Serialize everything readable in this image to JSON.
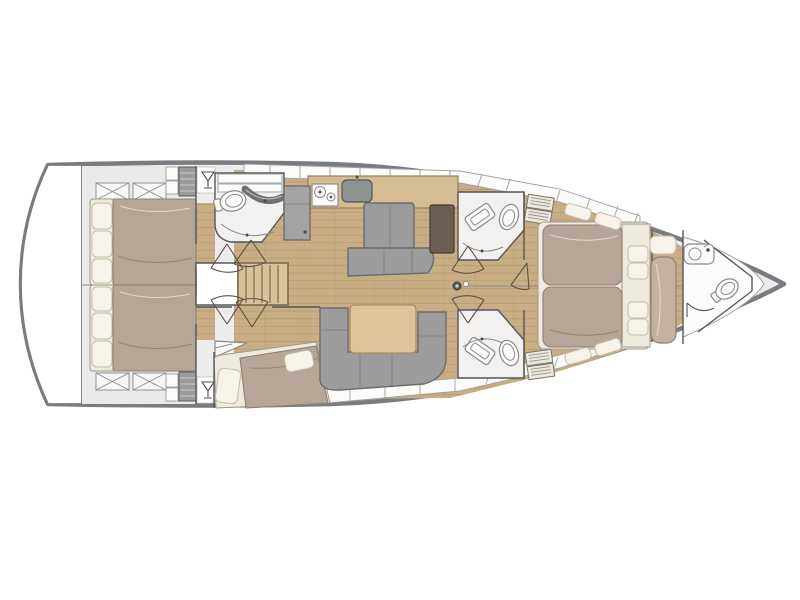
{
  "figure": {
    "type": "sailing-yacht-interior-layout-plan",
    "view": "top-down",
    "orientation": "bow-right"
  },
  "rooms": [
    "transom-platform",
    "aft-cabin-port",
    "aft-cabin-starboard",
    "companionway-stairs",
    "day-head",
    "galley",
    "nav-station",
    "salon-dinette",
    "mid-cabin-starboard",
    "shower-head-port",
    "shower-head-starboard",
    "owners-cabin",
    "bow-seat",
    "bow-head",
    "anchor-locker"
  ],
  "icons": {
    "deck_hatch": "square-with-x",
    "glass_locker": "martini-glass",
    "stove": "two-burner-circles",
    "sink": "basin-oval",
    "toilet": "oval-fixture",
    "mast": "center-circle",
    "door_swing": "v-lines-with-arc",
    "louver_locker": "slatted-rectangle"
  },
  "palette": {
    "background": "#ffffff",
    "hull_outline": "#797c80",
    "deck": "#ececec",
    "band_white": "#fbfbfa",
    "wall": "#55565a",
    "floor_wood": "#c9ad85",
    "floor_plank": "#a08862",
    "counter_wood": "#d6bc93",
    "table_wood": "#dfc49a",
    "stair_wood": "#d9c29a",
    "furniture_gray": "#9c9c9c",
    "furniture_gray_dark": "#6d6d6d",
    "appliance_gray": "#a3a3a3",
    "sink_gray": "#8e9494",
    "chart_brown": "#6b5f53",
    "duvet": "#b6a698",
    "duvet_dark": "#8d8071",
    "mattress": "#efeade",
    "pillow": "#f6f3ea",
    "pillow_line": "#c5bca9",
    "bath_floor": "#f2f1ef",
    "fixture": "#fbfbfa",
    "fixture_line": "#8a8a8a",
    "door_line": "#5d5246",
    "bench_taupe": "#c4b2a0"
  }
}
